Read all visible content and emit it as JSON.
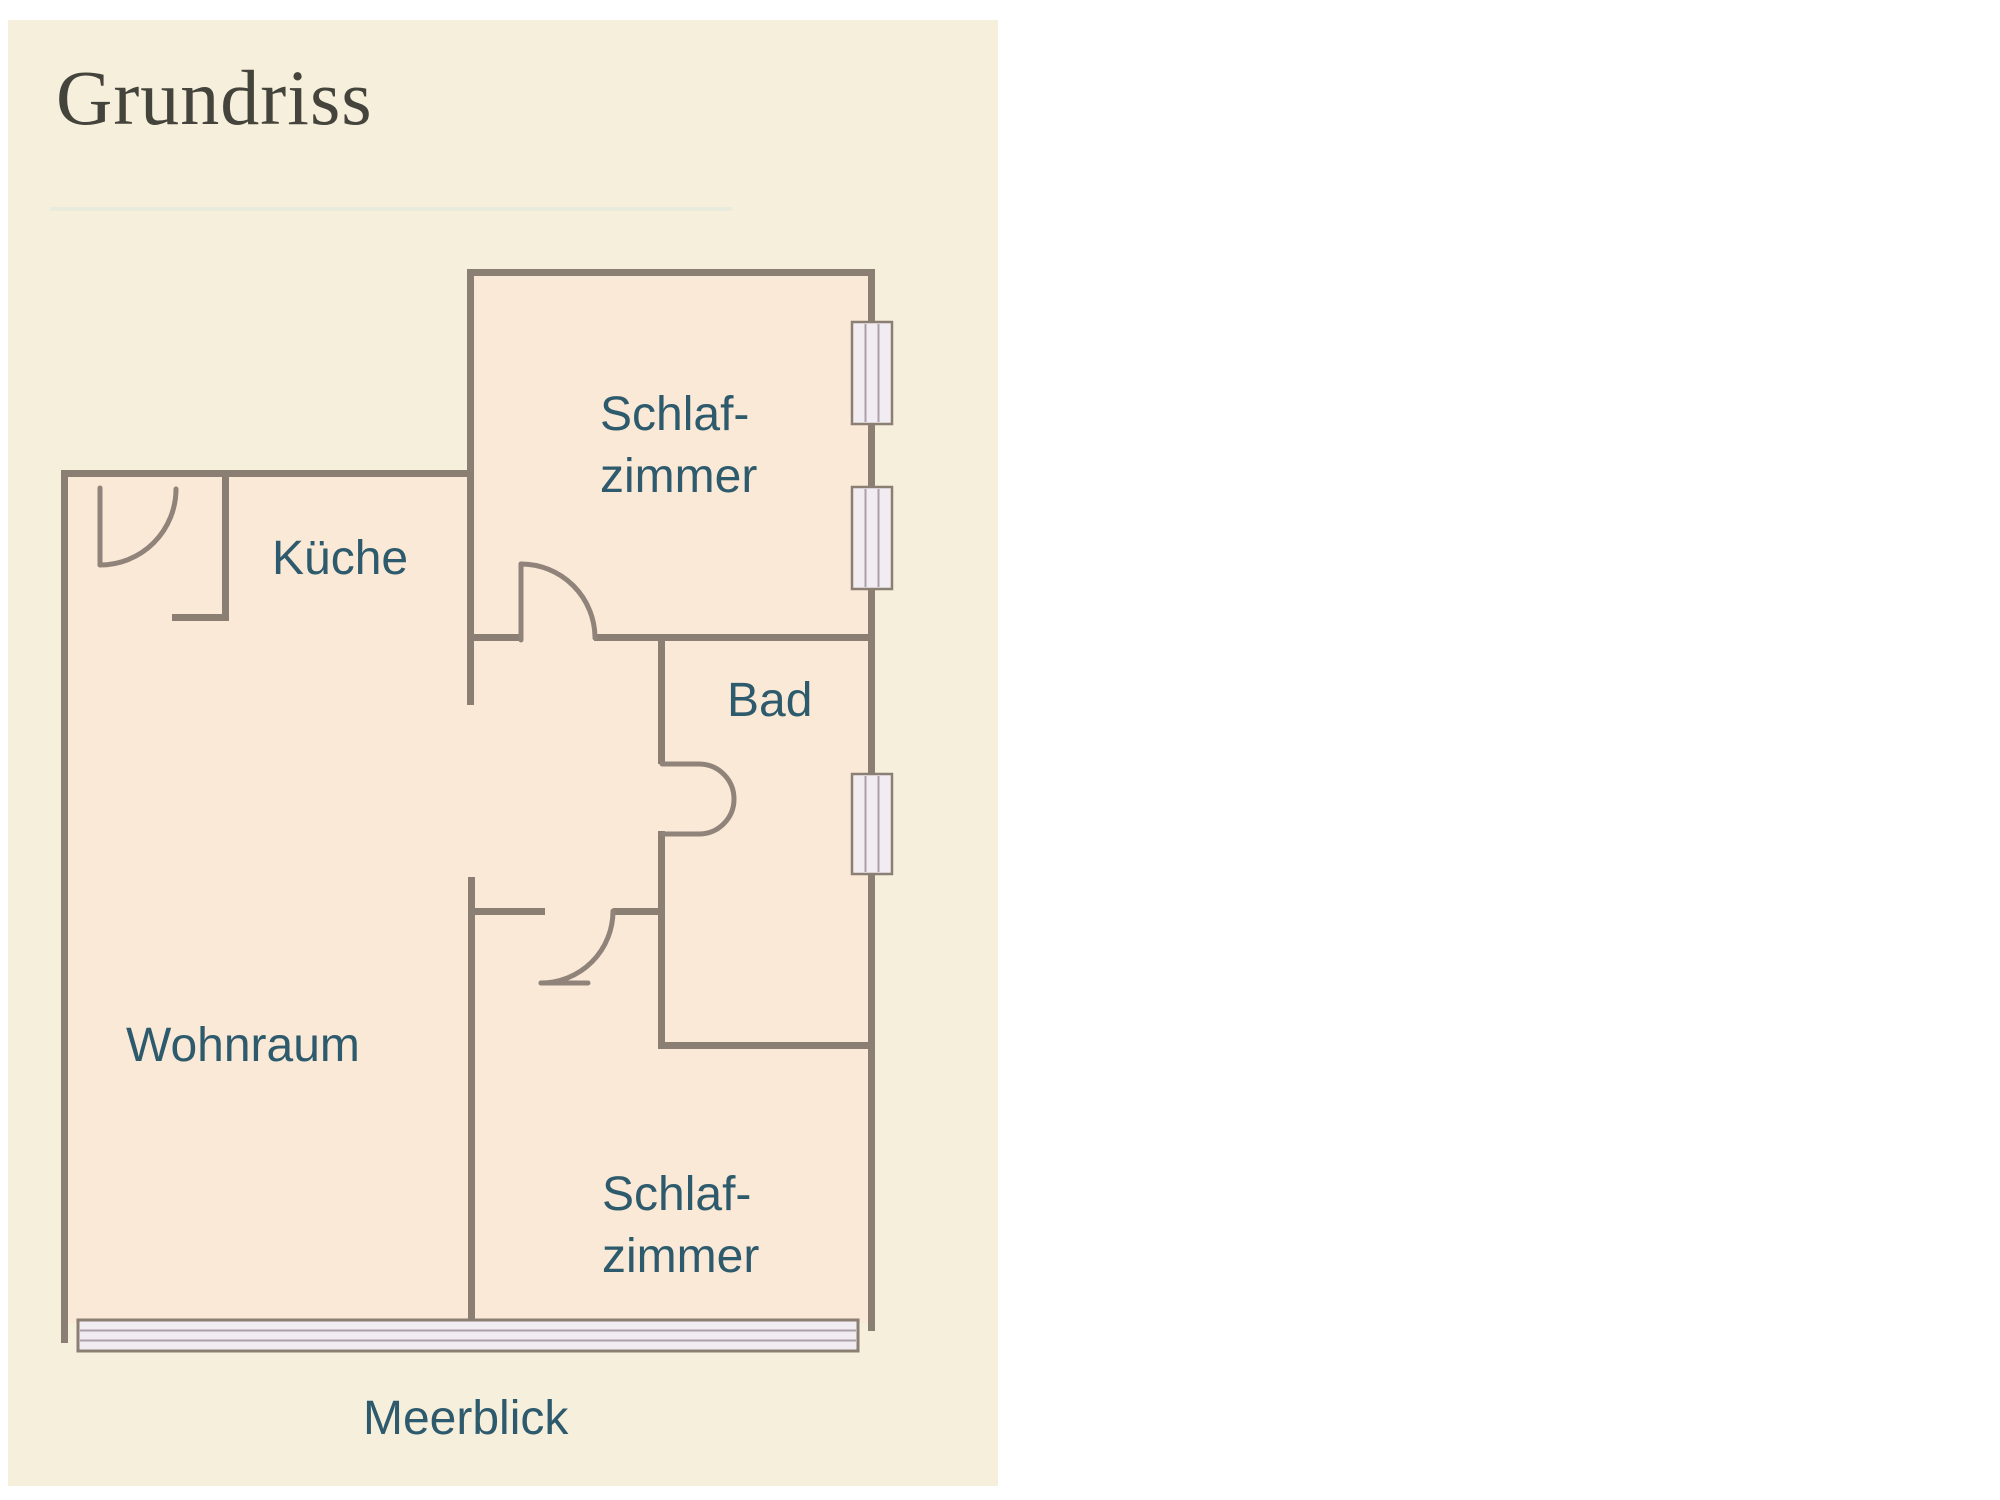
{
  "panel": {
    "title": "Grundriss"
  },
  "floorplan": {
    "labels": {
      "kueche": "Küche",
      "bad": "Bad",
      "wohnraum": "Wohnraum",
      "schlafzimmer_top": {
        "line1": "Schlaf-",
        "line2": "zimmer"
      },
      "schlafzimmer_bottom": {
        "line1": "Schlaf-",
        "line2": "zimmer"
      },
      "meerblick": "Meerblick"
    },
    "colors": {
      "panel_background": "#f6efdc",
      "room_fill": "#f9e9d6",
      "wall": "#8b7f73",
      "door": "#90837a",
      "window_fill": "#f1ecf2",
      "window_line": "#aaa0a6",
      "label_text": "#2d5a6c",
      "title_text": "#45443c",
      "divider": "#e9ebdc"
    },
    "window_count_right_wall": 3,
    "panorama_window_side": "bottom"
  }
}
